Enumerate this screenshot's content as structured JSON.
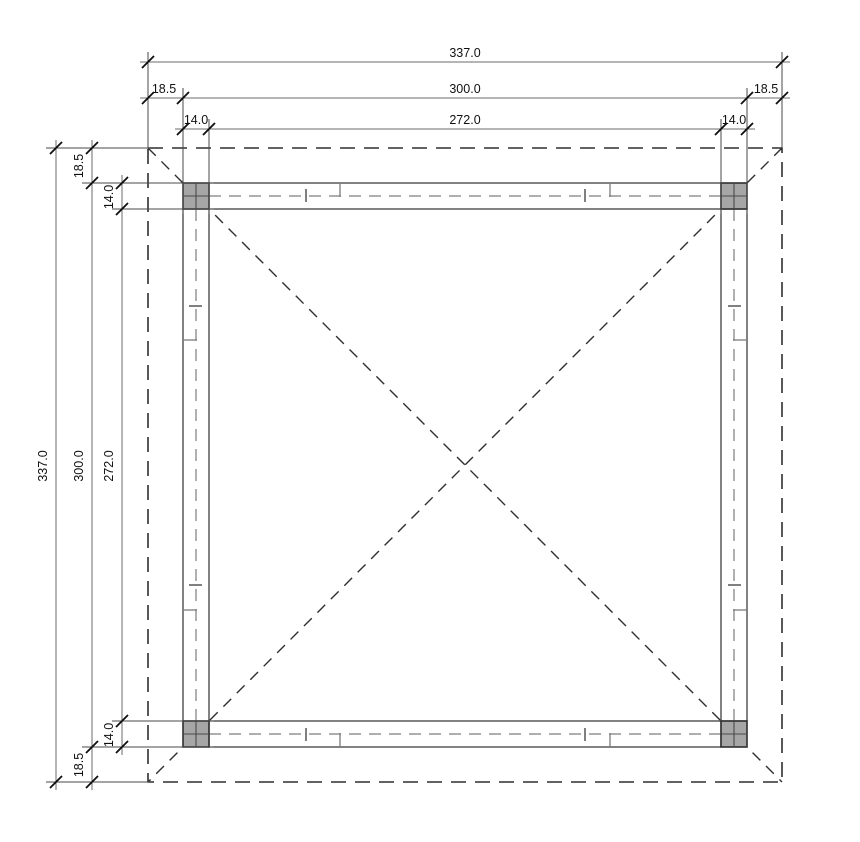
{
  "colors": {
    "outline": "#2f2f2f",
    "dim_line": "#6b6b6b",
    "ext_line": "#4a4a4a",
    "tick": "#0d0d0d",
    "text": "#111111",
    "hidden_line": "#7d7d7d",
    "diagonal": "#2f2f2f",
    "post_fill": "#a6a6a6",
    "post_stroke": "#2f2f2f",
    "bg": "#ffffff"
  },
  "dimensions": {
    "top": {
      "total": "337.0",
      "left_margin": "18.5",
      "span": "300.0",
      "right_margin": "18.5",
      "left_post": "14.0",
      "clear_span": "272.0",
      "right_post": "14.0"
    },
    "left": {
      "total": "337.0",
      "top_margin": "18.5",
      "span": "300.0",
      "bottom_margin": "18.5",
      "top_post": "14.0",
      "clear_span": "272.0",
      "bottom_post": "14.0"
    }
  }
}
